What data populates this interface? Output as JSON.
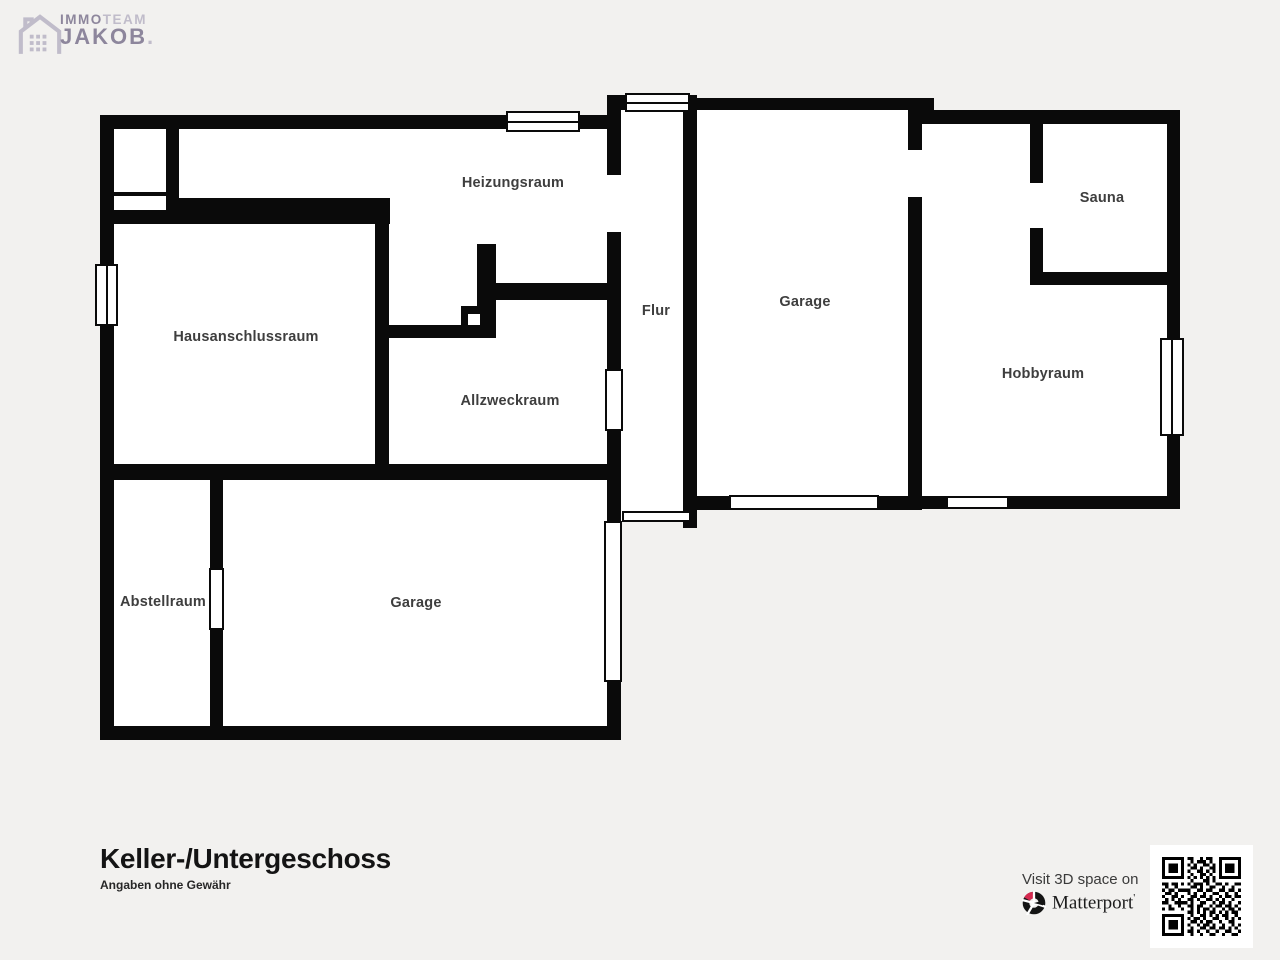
{
  "logo": {
    "immo": "IMMO",
    "team": "TEAM",
    "name": "JAKOB",
    "dot": "."
  },
  "rooms": [
    {
      "id": "heizungsraum",
      "label": "Heizungsraum"
    },
    {
      "id": "hausanschlussraum",
      "label": "Hausanschlussraum"
    },
    {
      "id": "allzweckraum",
      "label": "Allzweckraum"
    },
    {
      "id": "flur",
      "label": "Flur"
    },
    {
      "id": "garage-top",
      "label": "Garage"
    },
    {
      "id": "sauna",
      "label": "Sauna"
    },
    {
      "id": "hobbyraum",
      "label": "Hobbyraum"
    },
    {
      "id": "abstellraum",
      "label": "Abstellraum"
    },
    {
      "id": "garage-bottom",
      "label": "Garage"
    }
  ],
  "footer": {
    "title": "Keller-/Untergeschoss",
    "disclaimer": "Angaben ohne Gewähr"
  },
  "matterport": {
    "visit_text": "Visit 3D space on",
    "brand": "Matterport",
    "tm_mark": "'"
  },
  "colors": {
    "background": "#f2f1ef",
    "wall": "#0a0a0a",
    "room_label": "#3e3e3e",
    "logo_primary": "#8d869c",
    "logo_light": "#c0bcca",
    "matterport_red": "#d5294f"
  }
}
